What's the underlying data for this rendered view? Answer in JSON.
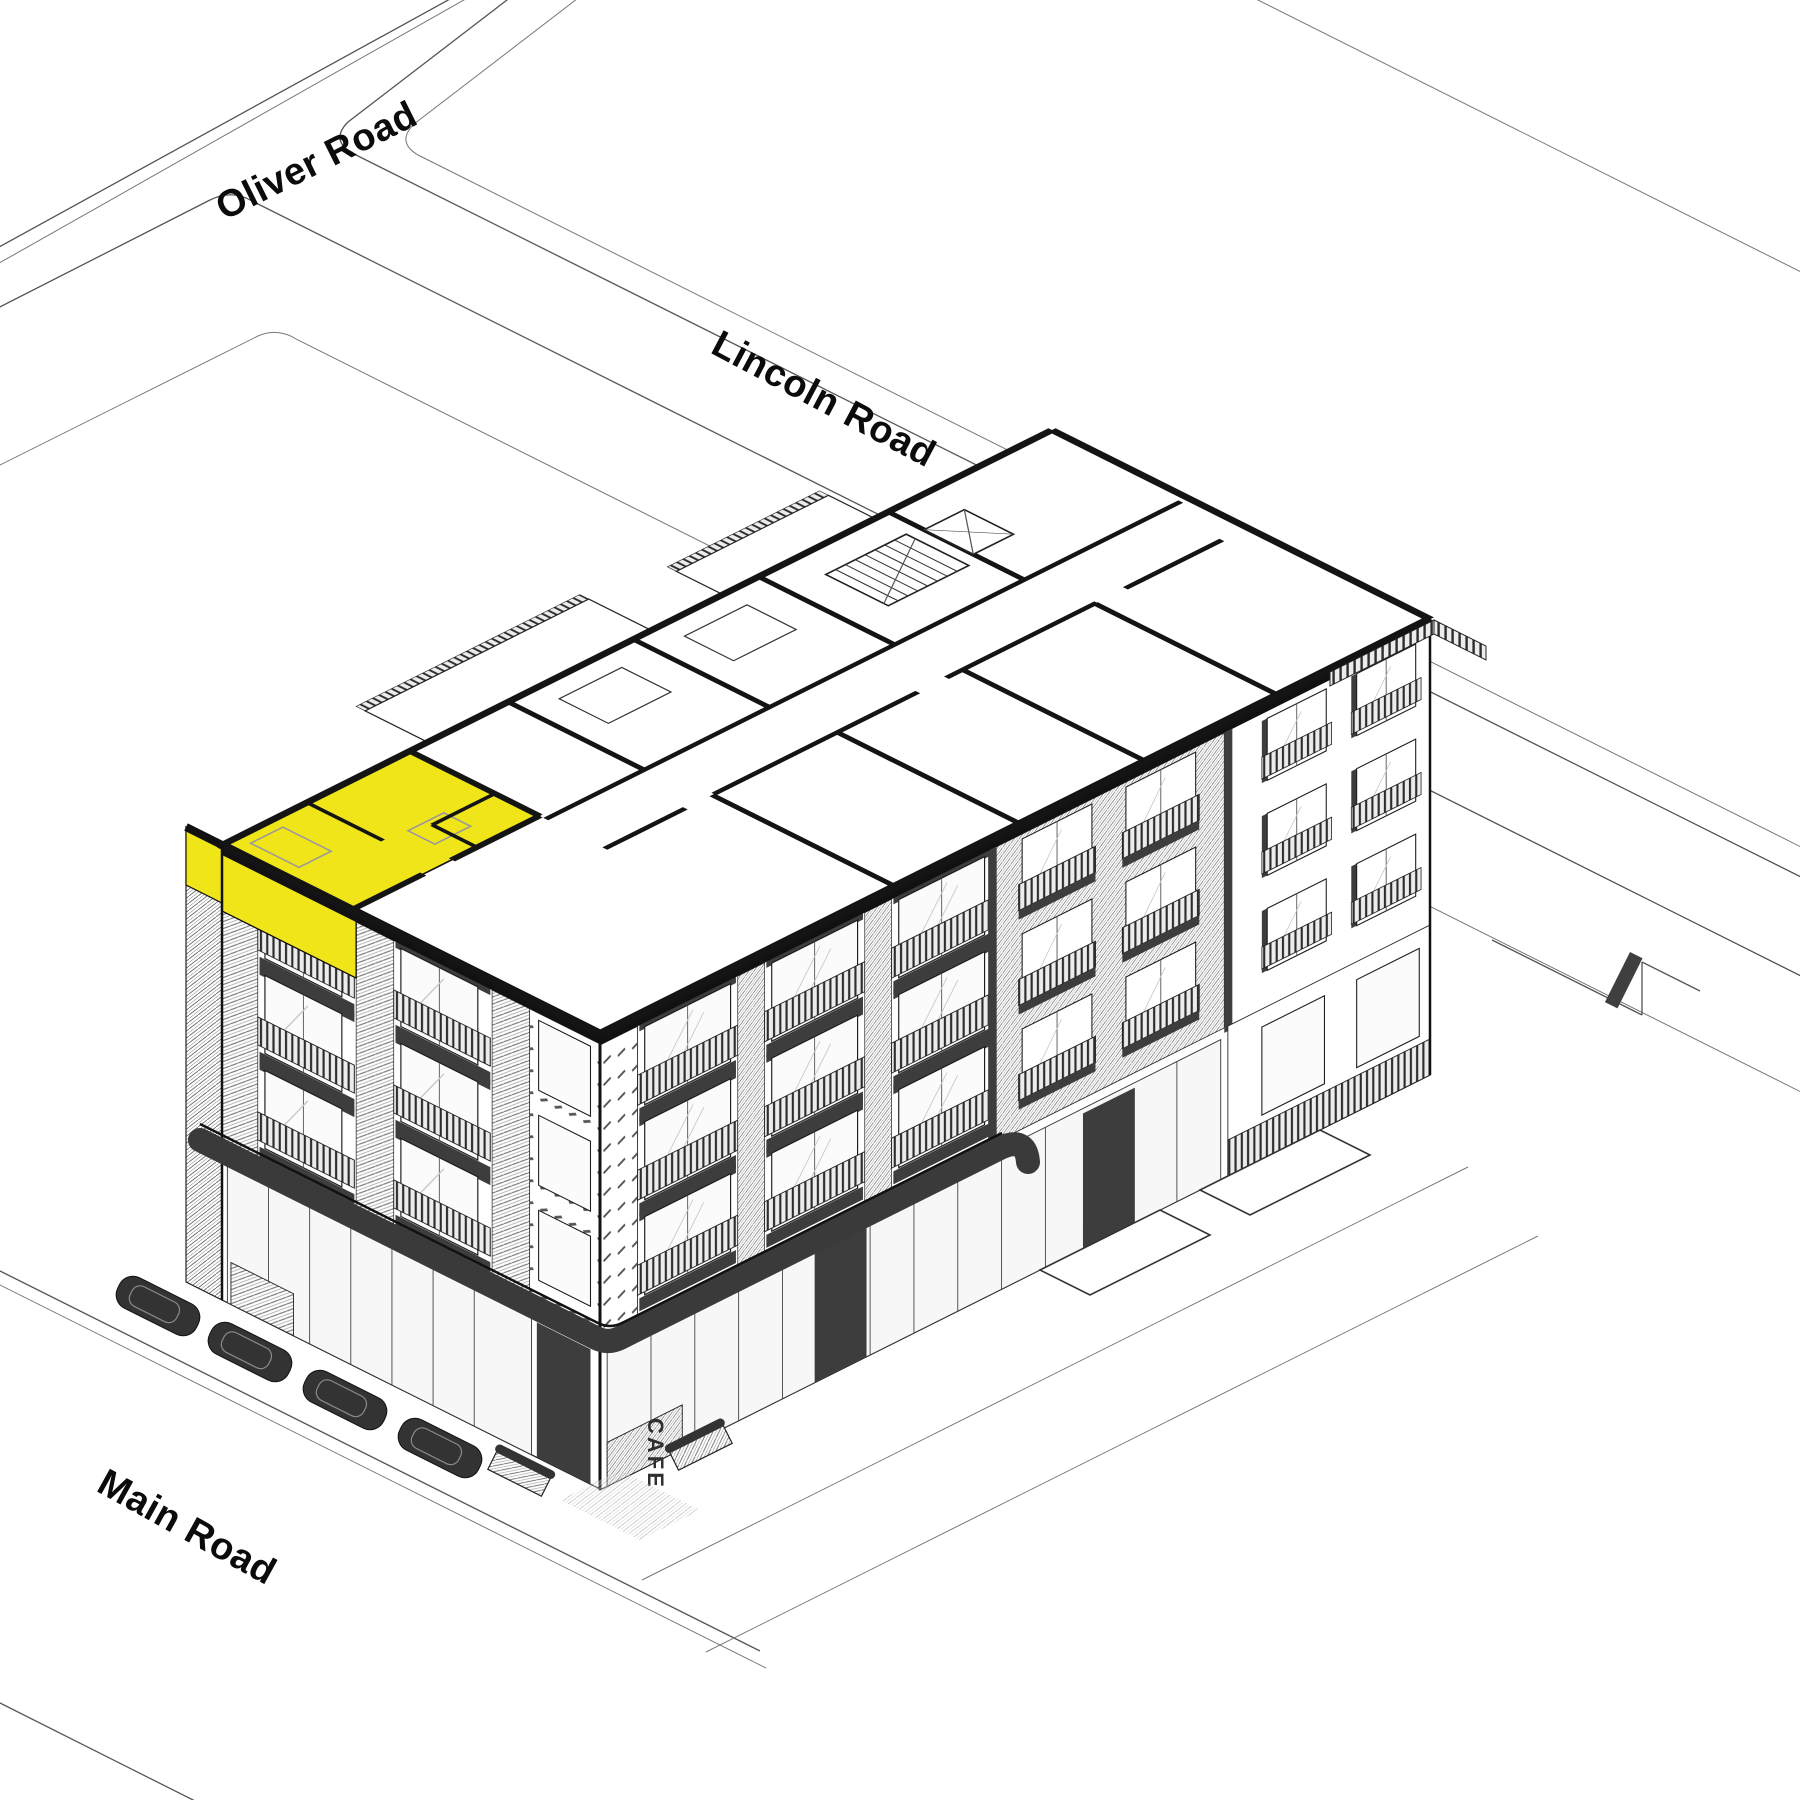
{
  "scene": {
    "background": "#ffffff",
    "description": "Axonometric cutaway diagram of an apartment block on a street corner with one top-floor unit highlighted"
  },
  "palette": {
    "line": "#1c1c1c",
    "dark_accent": "#3d3d3d",
    "canopy": "#3a3a3a",
    "highlight_yellow": "#F0E518",
    "car": "#333333"
  },
  "streets": {
    "oliver": {
      "label": "Oliver Road"
    },
    "lincoln": {
      "label": "Lincoln Road"
    },
    "main": {
      "label": "Main Road"
    }
  },
  "building": {
    "cafe_sign": "CAFE"
  }
}
